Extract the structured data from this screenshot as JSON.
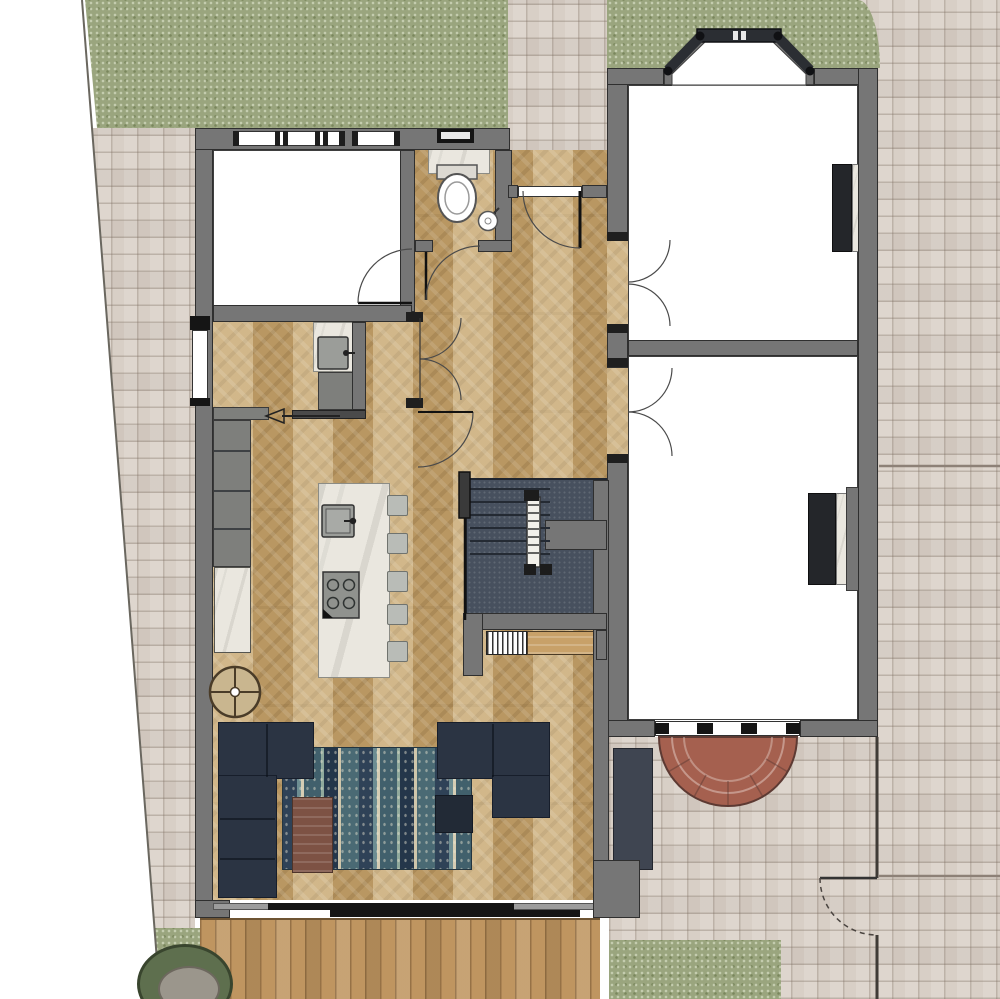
{
  "title": "Ground Floor Plan",
  "palette": {
    "wall": "#767676",
    "jamb": "#1f1f1f",
    "paving": "#d8cfc6",
    "grass": "#9aa57e",
    "wood": "#c2a069",
    "deck": "#bf9560",
    "carpet": "#47505e",
    "sofa": "#2b3443",
    "rug": "#4f6b75",
    "marble": "#eae7df",
    "brick": "#a5604f",
    "table": "#7d5244",
    "bin": "#3f4551",
    "white_room": "#ffffff",
    "bush": "#5e6f4e",
    "stone": "#9b968c"
  },
  "rooms": [
    {
      "name": "utility room"
    },
    {
      "name": "wc"
    },
    {
      "name": "hallway"
    },
    {
      "name": "kitchen diner"
    },
    {
      "name": "living area"
    },
    {
      "name": "front reception room"
    },
    {
      "name": "rear reception room"
    },
    {
      "name": "stairs"
    }
  ],
  "fixtures": [
    {
      "name": "toilet"
    },
    {
      "name": "corner basin"
    },
    {
      "name": "kitchen island with sink and hob"
    },
    {
      "name": "bar stools",
      "count": 5
    },
    {
      "name": "fireplace",
      "count": 2
    },
    {
      "name": "radiator"
    },
    {
      "name": "bench"
    },
    {
      "name": "bay window"
    },
    {
      "name": "sliding glass doors"
    },
    {
      "name": "brick step"
    },
    {
      "name": "garden gate"
    },
    {
      "name": "manhole cover"
    }
  ],
  "furniture": [
    {
      "name": "corner sofa left"
    },
    {
      "name": "corner sofa right"
    },
    {
      "name": "coffee table"
    },
    {
      "name": "side table"
    },
    {
      "name": "patterned rug"
    }
  ],
  "exterior": [
    {
      "name": "lawn"
    },
    {
      "name": "block paving"
    },
    {
      "name": "timber deck"
    },
    {
      "name": "shrub"
    }
  ]
}
